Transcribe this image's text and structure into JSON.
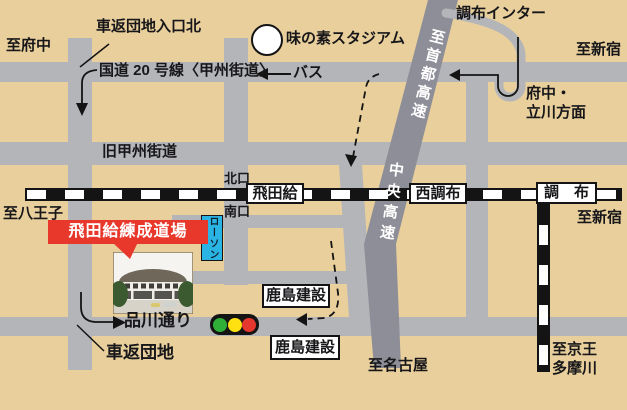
{
  "colors": {
    "background": "#e9cf9c",
    "road_gray": "#b4b5b9",
    "expressway_gray": "#8e8e98",
    "rail_black": "#141414",
    "banner_red": "#e8382c",
    "lawson_blue": "#2ab4e4",
    "traffic_light_green": "#2fae38",
    "traffic_light_yellow": "#ffe112",
    "traffic_light_red": "#e6372e"
  },
  "destinations": {
    "fuchu": "至府中",
    "shinjuku_road": "至新宿",
    "shinjuku_rail": "至新宿",
    "hachioji": "至八王子",
    "nagoya": "至名古屋",
    "keio_tamagawa_line1": "至京王",
    "keio_tamagawa_line2": "多摩川"
  },
  "roads": {
    "route20": "国道 20 号線〈甲州街道〉",
    "old_koshu": "旧甲州街道",
    "shinagawa": "品川通り",
    "shuto_expressway": "至首都高速",
    "chuo_expressway": "中央高速",
    "chofu_inter": "調布インター",
    "fuchu_tachikawa_line1": "府中・",
    "fuchu_tachikawa_line2": "立川方面",
    "bus": "バス"
  },
  "stations": {
    "tobitakyu": "飛田給",
    "nishichofu": "西調布",
    "chofu": "調　布",
    "north_exit": "北口",
    "south_exit": "南口"
  },
  "landmarks": {
    "stadium": "味の素スタジアム",
    "dojo_banner": "飛田給練成道場",
    "lawson": "ローソン",
    "kajima_1": "鹿島建設",
    "kajima_2": "鹿島建設",
    "kurumagaeshi_entrance": "車返団地入口北",
    "kurumagaeshi_danchi": "車返団地"
  }
}
